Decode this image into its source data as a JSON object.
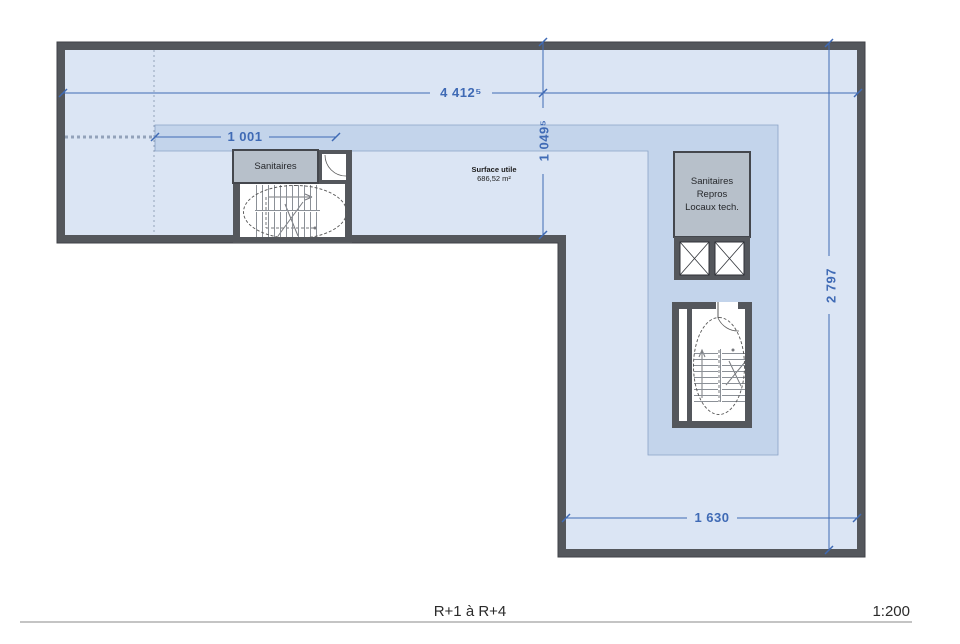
{
  "plan": {
    "footer": {
      "levels": "R+1 à R+4",
      "scale": "1:200"
    },
    "dimensions": {
      "total_width": "4 412⁵",
      "left_zone_width": "1 001",
      "bar_depth": "1 049⁵",
      "right_leg_height": "2 797",
      "right_leg_width": "1 630"
    },
    "rooms": {
      "left_sanitaires": "Sanitaires",
      "right_block_line1": "Sanitaires",
      "right_block_line2": "Repros",
      "right_block_line3": "Locaux tech."
    },
    "surface": {
      "label": "Surface utile",
      "value": "686,52 m²"
    },
    "colors": {
      "floor": "#dbe5f4",
      "highlight_zone": "#c3d4eb",
      "wall": "#54575c",
      "dimension_blue": "#3f6ab5",
      "room_box_gray": "#b7c0ca"
    }
  }
}
